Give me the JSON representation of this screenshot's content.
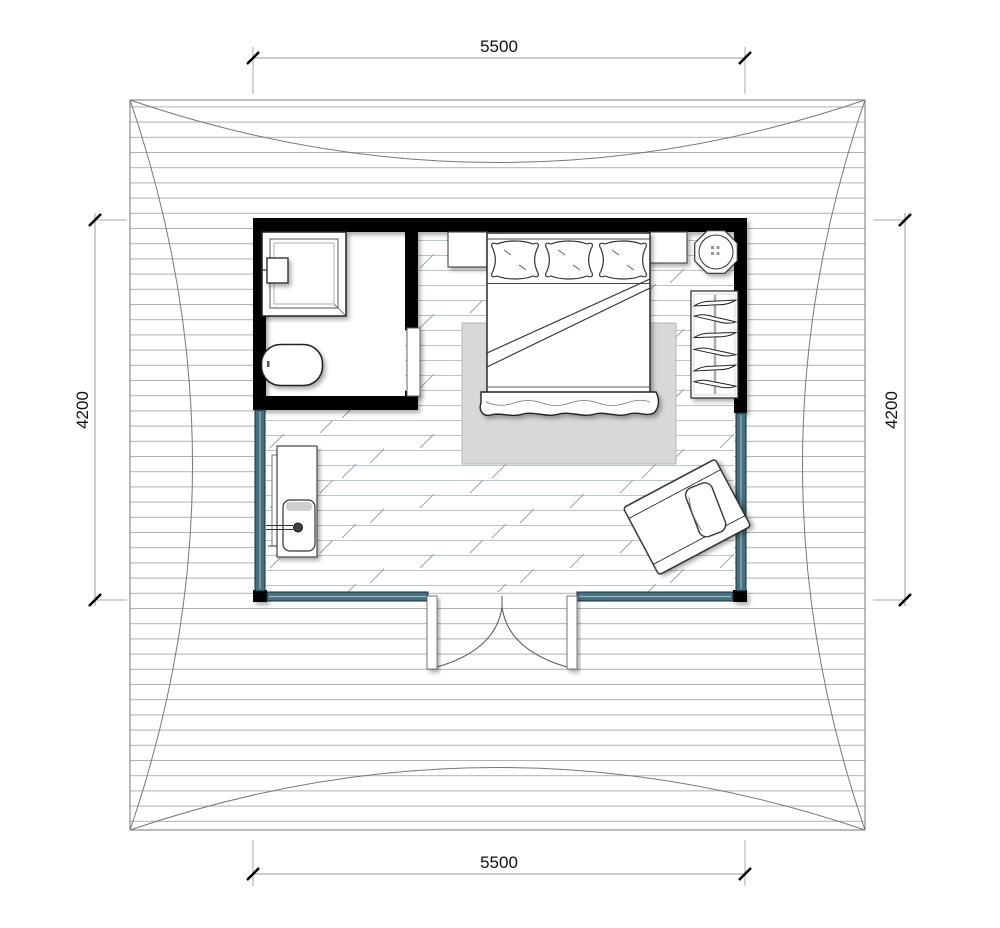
{
  "plan": {
    "type": "architectural-floor-plan",
    "dimensions": {
      "top": {
        "label": "5500"
      },
      "bottom": {
        "label": "5500"
      },
      "left": {
        "label": "4200"
      },
      "right": {
        "label": "4200"
      }
    },
    "colors": {
      "wall": "#000000",
      "glazing": "#46707f",
      "rug": "#d8d8d8",
      "floor_line": "#bcc3c7",
      "roof_line": "#b0b0b0",
      "dimension_text": "#111111"
    },
    "symbols": [
      "wood-deck-roof",
      "solid-wall",
      "glazed-wall",
      "shower",
      "shower-control-box",
      "toilet",
      "sliding-door",
      "double-bed",
      "pillow",
      "nightstand",
      "round-side-table",
      "wardrobe-with-hangers",
      "area-rug",
      "sink-counter",
      "faucet",
      "lounge-chair",
      "double-entry-door"
    ]
  }
}
